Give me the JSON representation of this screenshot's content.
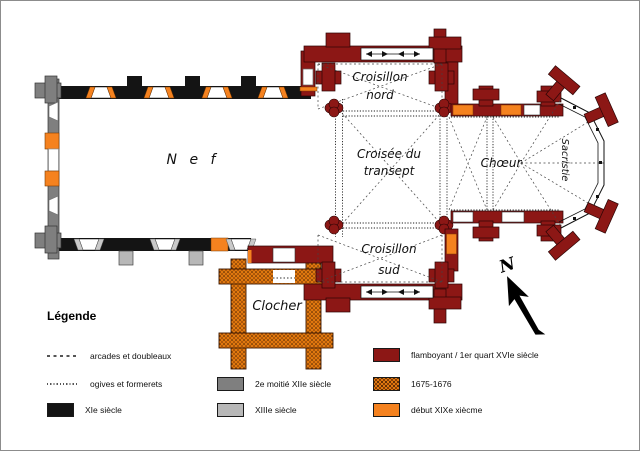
{
  "plan": {
    "labels": {
      "nef": "N e f",
      "croisillon_nord": [
        "Croisillon",
        "nord"
      ],
      "croisee": [
        "Croisée du",
        "transept"
      ],
      "choeur": "Chœur",
      "sacristie": "Sacristie",
      "croisillon_sud": [
        "Croisillon",
        "sud"
      ],
      "clocher": "Clocher"
    },
    "compass_n": "N"
  },
  "legend": {
    "title": "Légende",
    "items": [
      {
        "label": "arcades et doubleaux",
        "sample": "dashed-line"
      },
      {
        "label": "ogives et formerets",
        "sample": "dotted-line"
      },
      {
        "label": "XIe siècle",
        "sample": "swatch",
        "color": "#141414"
      },
      {
        "label": "2e moitié XIIe siècle",
        "sample": "swatch",
        "color": "#7f7f7f"
      },
      {
        "label": "XIIIe siècle",
        "sample": "swatch",
        "color": "#b8b8b8"
      },
      {
        "label": "flamboyant / 1er quart XVIe siècle",
        "sample": "swatch",
        "color": "#8c1715"
      },
      {
        "label": "1675-1676",
        "sample": "swatch-stipple",
        "color": "#e0780f"
      },
      {
        "label": "début XIXe xiècme",
        "sample": "swatch",
        "color": "#f5821f"
      }
    ]
  },
  "colors": {
    "xie_siecle": "#141414",
    "xiie_siecle": "#7f7f7f",
    "xiiie_siecle": "#b8b8b8",
    "flamboyant_xvie": "#8c1715",
    "periode_1675": "#e0780f",
    "debut_xixe": "#f5821f"
  }
}
